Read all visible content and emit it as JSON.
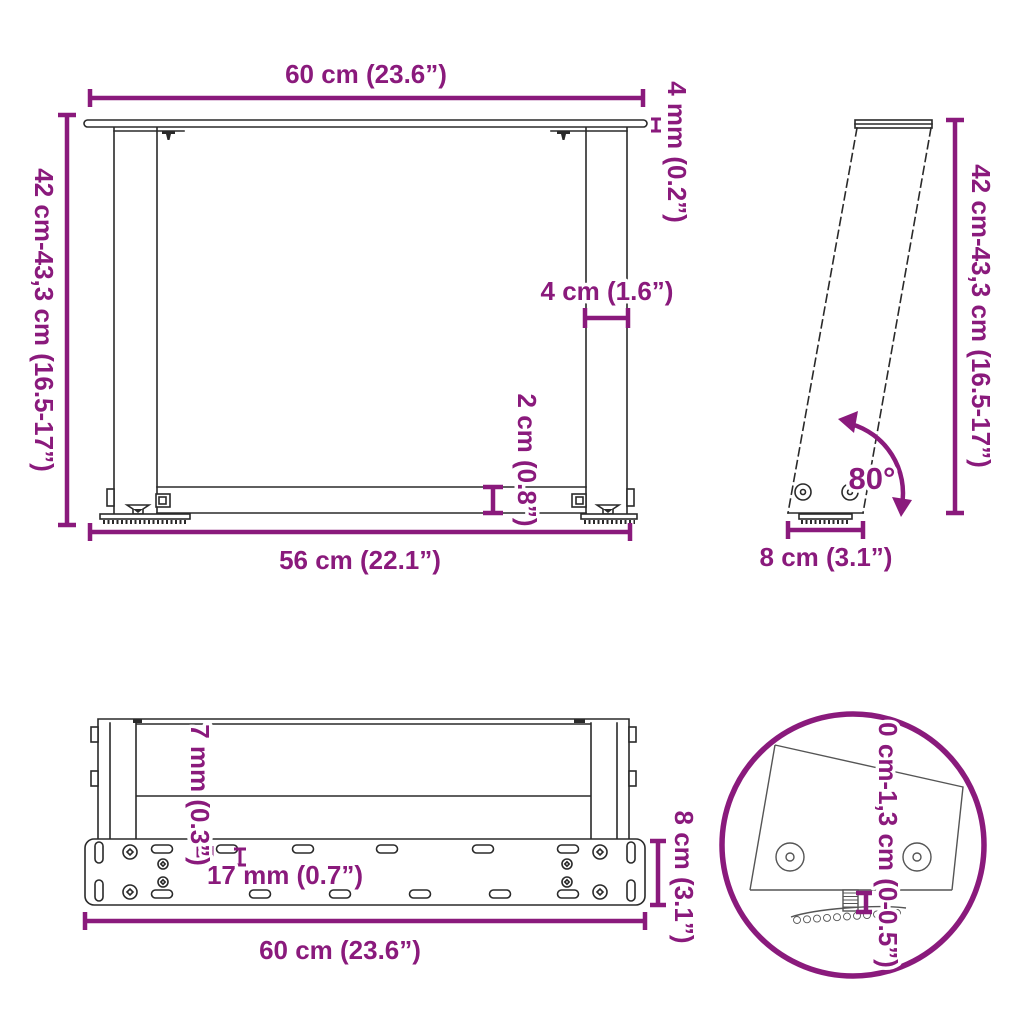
{
  "colors": {
    "dimension": "#8a1a7c",
    "line": "#2a2a2a",
    "detail_line": "#555555",
    "background": "#ffffff"
  },
  "views": {
    "front": {
      "width_top": "60 cm (23.6”)",
      "plate_thickness": "4 mm (0.2”)",
      "height_range": "42 cm-43,3 cm (16.5-17”)",
      "leg_width": "4 cm (1.6”)",
      "crossbar_height": "2 cm (0.8”)",
      "width_bottom": "56 cm (22.1”)"
    },
    "side": {
      "height_range": "42 cm-43,3 cm (16.5-17”)",
      "tilt_angle": "80°",
      "foot_depth": "8 cm (3.1”)"
    },
    "plan": {
      "hole_diameter": "7 mm (0.3”)",
      "slot_length": "17 mm (0.7”)",
      "plate_depth": "8 cm (3.1”)",
      "plate_width": "60 cm (23.6”)"
    },
    "detail": {
      "adjustment_range": "0 cm-1,3 cm (0-0.5”)"
    }
  }
}
